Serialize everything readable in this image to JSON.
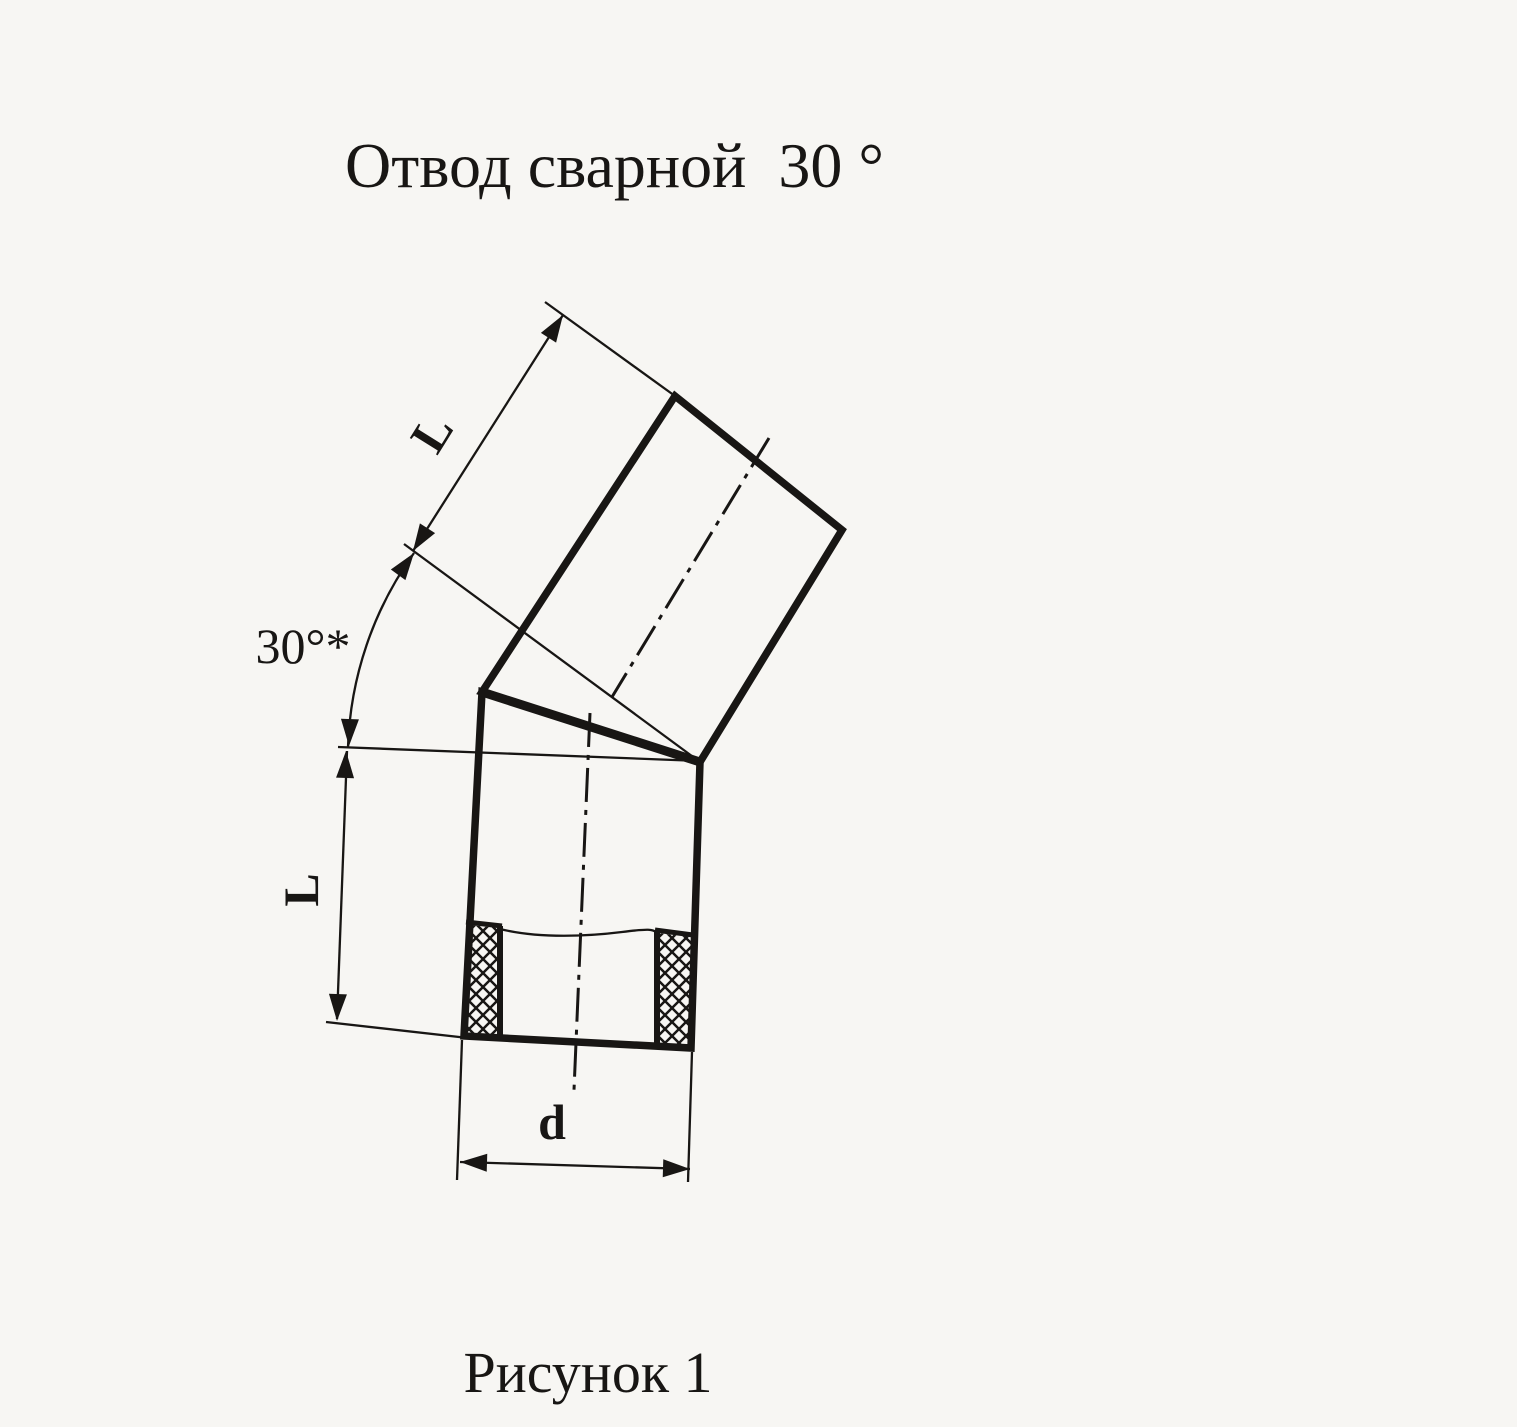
{
  "page": {
    "background_color": "#f7f6f3",
    "ink_color": "#181614"
  },
  "document": {
    "title": "Отвод сварной  30 °",
    "caption": "Рисунок 1"
  },
  "drawing": {
    "type": "welded pipe elbow, two mitered segments shown in section",
    "labels": {
      "upper_length": "L",
      "lower_length": "L",
      "angle": "30°*",
      "diameter": "d"
    }
  }
}
